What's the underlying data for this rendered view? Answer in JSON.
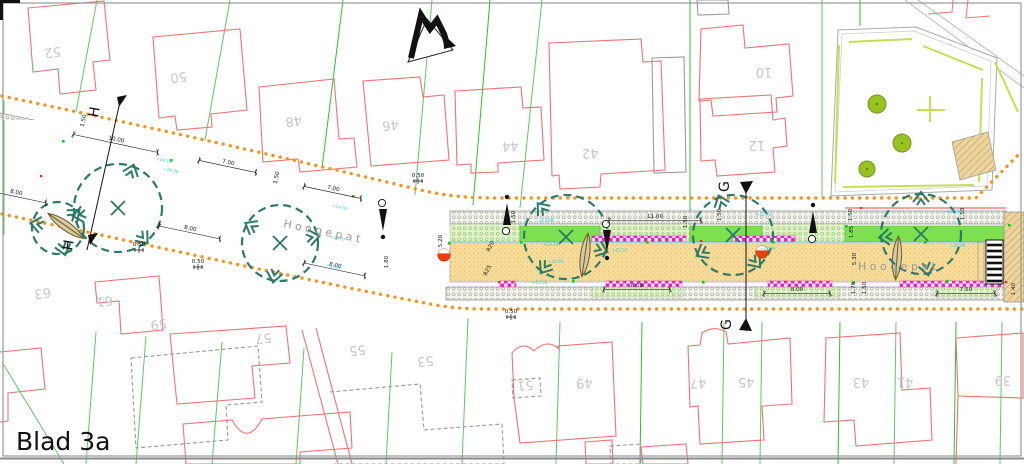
{
  "sheet": {
    "label": "Blad 3a"
  },
  "street": {
    "name_left": "Hoogepat",
    "name_right": "Hoogepat"
  },
  "sections": {
    "h_top": "H",
    "h_bottom": "H",
    "g_top": "G",
    "g_bottom": "G"
  },
  "house_numbers": {
    "top": [
      "52",
      "50",
      "48",
      "46",
      "44",
      "42",
      "10",
      "12"
    ],
    "bottom": [
      "63",
      "61",
      "59",
      "57",
      "55",
      "53",
      "51",
      "49",
      "47",
      "45",
      "43",
      "41",
      "39"
    ]
  },
  "dimensions": [
    "1.50",
    "10.00",
    "7.00",
    "7.00",
    "8.00",
    "1.50",
    "8.00",
    "8.00",
    "0.50",
    "0.50",
    "0.50",
    "0.50",
    "5.20",
    "1.80",
    "R20",
    "R25",
    "1.50",
    "11.00",
    "8.00",
    "1.50",
    "1.50",
    "8.00",
    "1.76",
    "1.50",
    "7.50",
    "1.40",
    "1.50",
    "1.85",
    "5.30",
    "1.50"
  ],
  "elevations": [
    "+24.16",
    "+24.08",
    "+24.02",
    "+23.97",
    "+23.92",
    "+23.88",
    "+23.10",
    "+23.06",
    "+23.02",
    "+22.97",
    "+22.94",
    "+22.90",
    "+20.98",
    "+20.89"
  ],
  "icons": [
    "north-arrow-icon",
    "tree-symbol-icon",
    "lamppost-icon",
    "speed-bump-icon",
    "crosswalk-ladder-icon",
    "section-flag-icon",
    "park-tree-icon"
  ],
  "colors": {
    "roadway": "#f8dc99",
    "roadway_speckle": "#e2ab55",
    "parking_magenta": "#fb15d9",
    "grass_bright": "#7de14e",
    "grass_paver": "#e2f3c9",
    "sidewalk_paver": "#f3f3ee",
    "tree_outline": "#2c7a69",
    "boundary_orange": "#f7941d",
    "parcel_green": "#5ec95e",
    "house_red": "#f07373",
    "existing_gray": "#9a9a9a",
    "elevation_cyan": "#2cd2e6",
    "park_line": "#c3e052",
    "edge_blue": "#a8dcf0"
  }
}
